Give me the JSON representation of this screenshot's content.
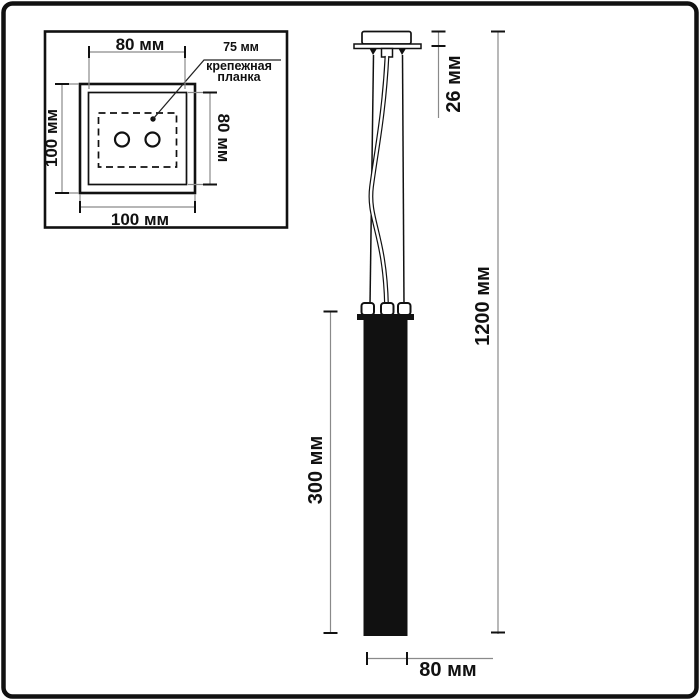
{
  "inset": {
    "dims": {
      "top": "80 мм",
      "left": "100 мм",
      "right": "80 мм",
      "bottom": "100 мм"
    },
    "callout": {
      "value": "75 мм",
      "label_line1": "крепежная",
      "label_line2": "планка"
    }
  },
  "main": {
    "dims": {
      "canopy_height": "26 мм",
      "total_height": "1200 мм",
      "tube_height": "300 мм",
      "tube_width": "80 мм"
    }
  },
  "colors": {
    "ink": "#111111",
    "dim_line": "#8a8a8a",
    "background": "#ffffff"
  }
}
